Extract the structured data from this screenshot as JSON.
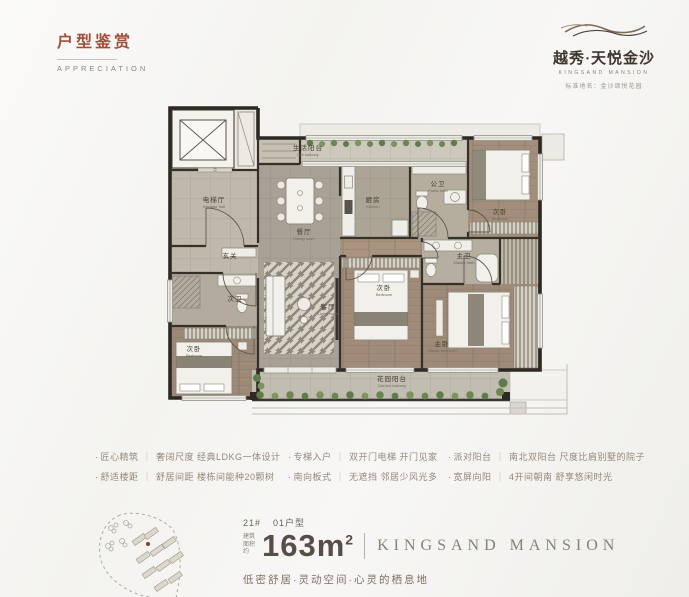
{
  "colors": {
    "accent_red": "#a34e3b",
    "ink": "#3c362e",
    "warm_gray": "#93897b",
    "brand_brown": "#8b8173",
    "wall": "#2c2822",
    "green": "#5e7c4a"
  },
  "header": {
    "title_zh": "户型鉴赏",
    "title_en": "APPRECIATION"
  },
  "logo": {
    "brand_zh": "越秀·天悦金沙",
    "brand_en": "KINGSAND MANSION",
    "standard_name": "标准地名：金沙颂悦花园"
  },
  "floor_plan": {
    "rooms": {
      "elevator_hall": {
        "zh": "电梯厅",
        "en": "Elevator hall"
      },
      "life_balcony": {
        "zh": "生活阳台",
        "en": "Life balcony"
      },
      "dining": {
        "zh": "餐厅",
        "en": "Dining room"
      },
      "kitchen": {
        "zh": "厨房",
        "en": "Kitchen"
      },
      "public_bath": {
        "zh": "公卫",
        "en": "Public bath"
      },
      "bedroom_a": {
        "zh": "次卧",
        "en": "Bedroom"
      },
      "entry": {
        "zh": "玄关"
      },
      "bath_b": {
        "zh": "次卫"
      },
      "bedroom_b": {
        "zh": "次卧",
        "en": "Bedroom"
      },
      "living": {
        "zh": "客厅",
        "en": "Living room"
      },
      "bedroom_c": {
        "zh": "次卧",
        "en": "Bedroom"
      },
      "master_bath": {
        "zh": "主卫",
        "en": "Master bath"
      },
      "master_bedroom": {
        "zh": "主卧",
        "en": "Master bedroom"
      },
      "garden_balcony": {
        "zh": "花园阳台",
        "en": "Garden balcony"
      }
    }
  },
  "features": {
    "bullet": "·",
    "divider": "｜",
    "items": [
      {
        "label": "匠心精筑",
        "desc": "奢阔尺度 经典LDKG一体设计"
      },
      {
        "label": "舒适楼距",
        "desc": "舒居间距 楼栋间能种20颗树"
      },
      {
        "label": "专梯入户",
        "desc": "双开门电梯 开门见家"
      },
      {
        "label": "南向板式",
        "desc": "无遮挡 邻居少风光多"
      },
      {
        "label": "派对阳台",
        "desc": "南北双阳台 尺度比肩别墅的院子"
      },
      {
        "label": "宽屏向阳",
        "desc": "4开间朝南 舒享悠闲时光"
      }
    ]
  },
  "unit": {
    "number": "21#",
    "type": "01户型",
    "area_prefix": "建筑面积约",
    "area_value": "163m",
    "area_sup": "2",
    "brand": "KINGSAND MANSION",
    "tagline": "低密舒居·灵动空间·心灵的栖息地"
  }
}
